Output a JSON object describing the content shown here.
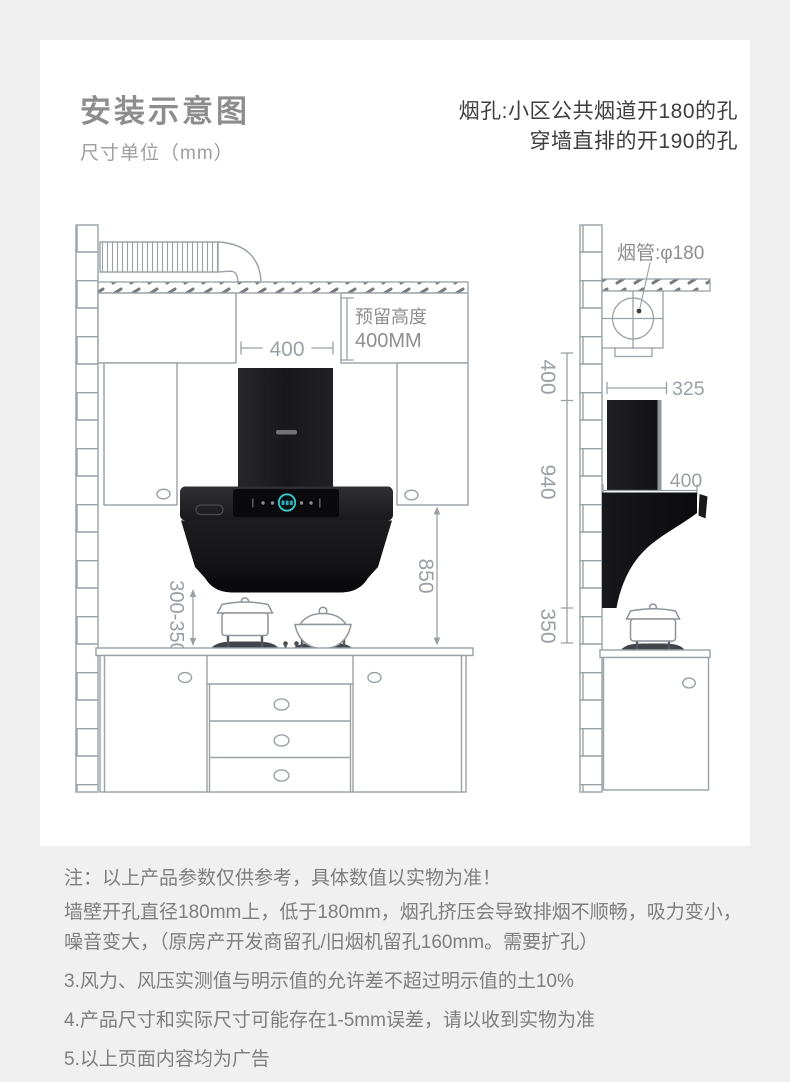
{
  "header": {
    "title": "安装示意图",
    "unit_note": "尺寸单位（mm）",
    "vent_note_line1": "烟孔:小区公共烟道开180的孔",
    "vent_note_line2": "穿墙直排的开190的孔"
  },
  "front_view": {
    "hood_width": "400",
    "reserved_line1": "预留高度",
    "reserved_line2": "400MM",
    "hood_to_counter": "850",
    "hood_to_cooktop": "300-350"
  },
  "side_view": {
    "duct_label": "烟管:φ180",
    "top_clearance": "400",
    "hood_height": "940",
    "bottom_clearance": "350",
    "chimney_width": "325",
    "hood_depth": "400"
  },
  "notes": [
    "注：以上产品参数仅供参考，具体数值以实物为准！",
    "墙壁开孔直径180mm上，低于180mm，烟孔挤压会导致排烟不顺畅，吸力变小，噪音变大，（原房产开发商留孔/旧烟机留孔160mm。需要扩孔）",
    "3.风力、风压实测值与明示值的允许差不超过明示值的土10%",
    "4.产品尺寸和实际尺寸可能存在1-5mm误差，请以收到实物为准",
    "5.以上页面内容均为广告"
  ],
  "colors": {
    "accent_ring": "#38c6c6",
    "hood_black": "#141416",
    "line_gray": "#9aa1a7",
    "title_gray": "#8d8d8d",
    "note_gray": "#7e7e7e"
  }
}
